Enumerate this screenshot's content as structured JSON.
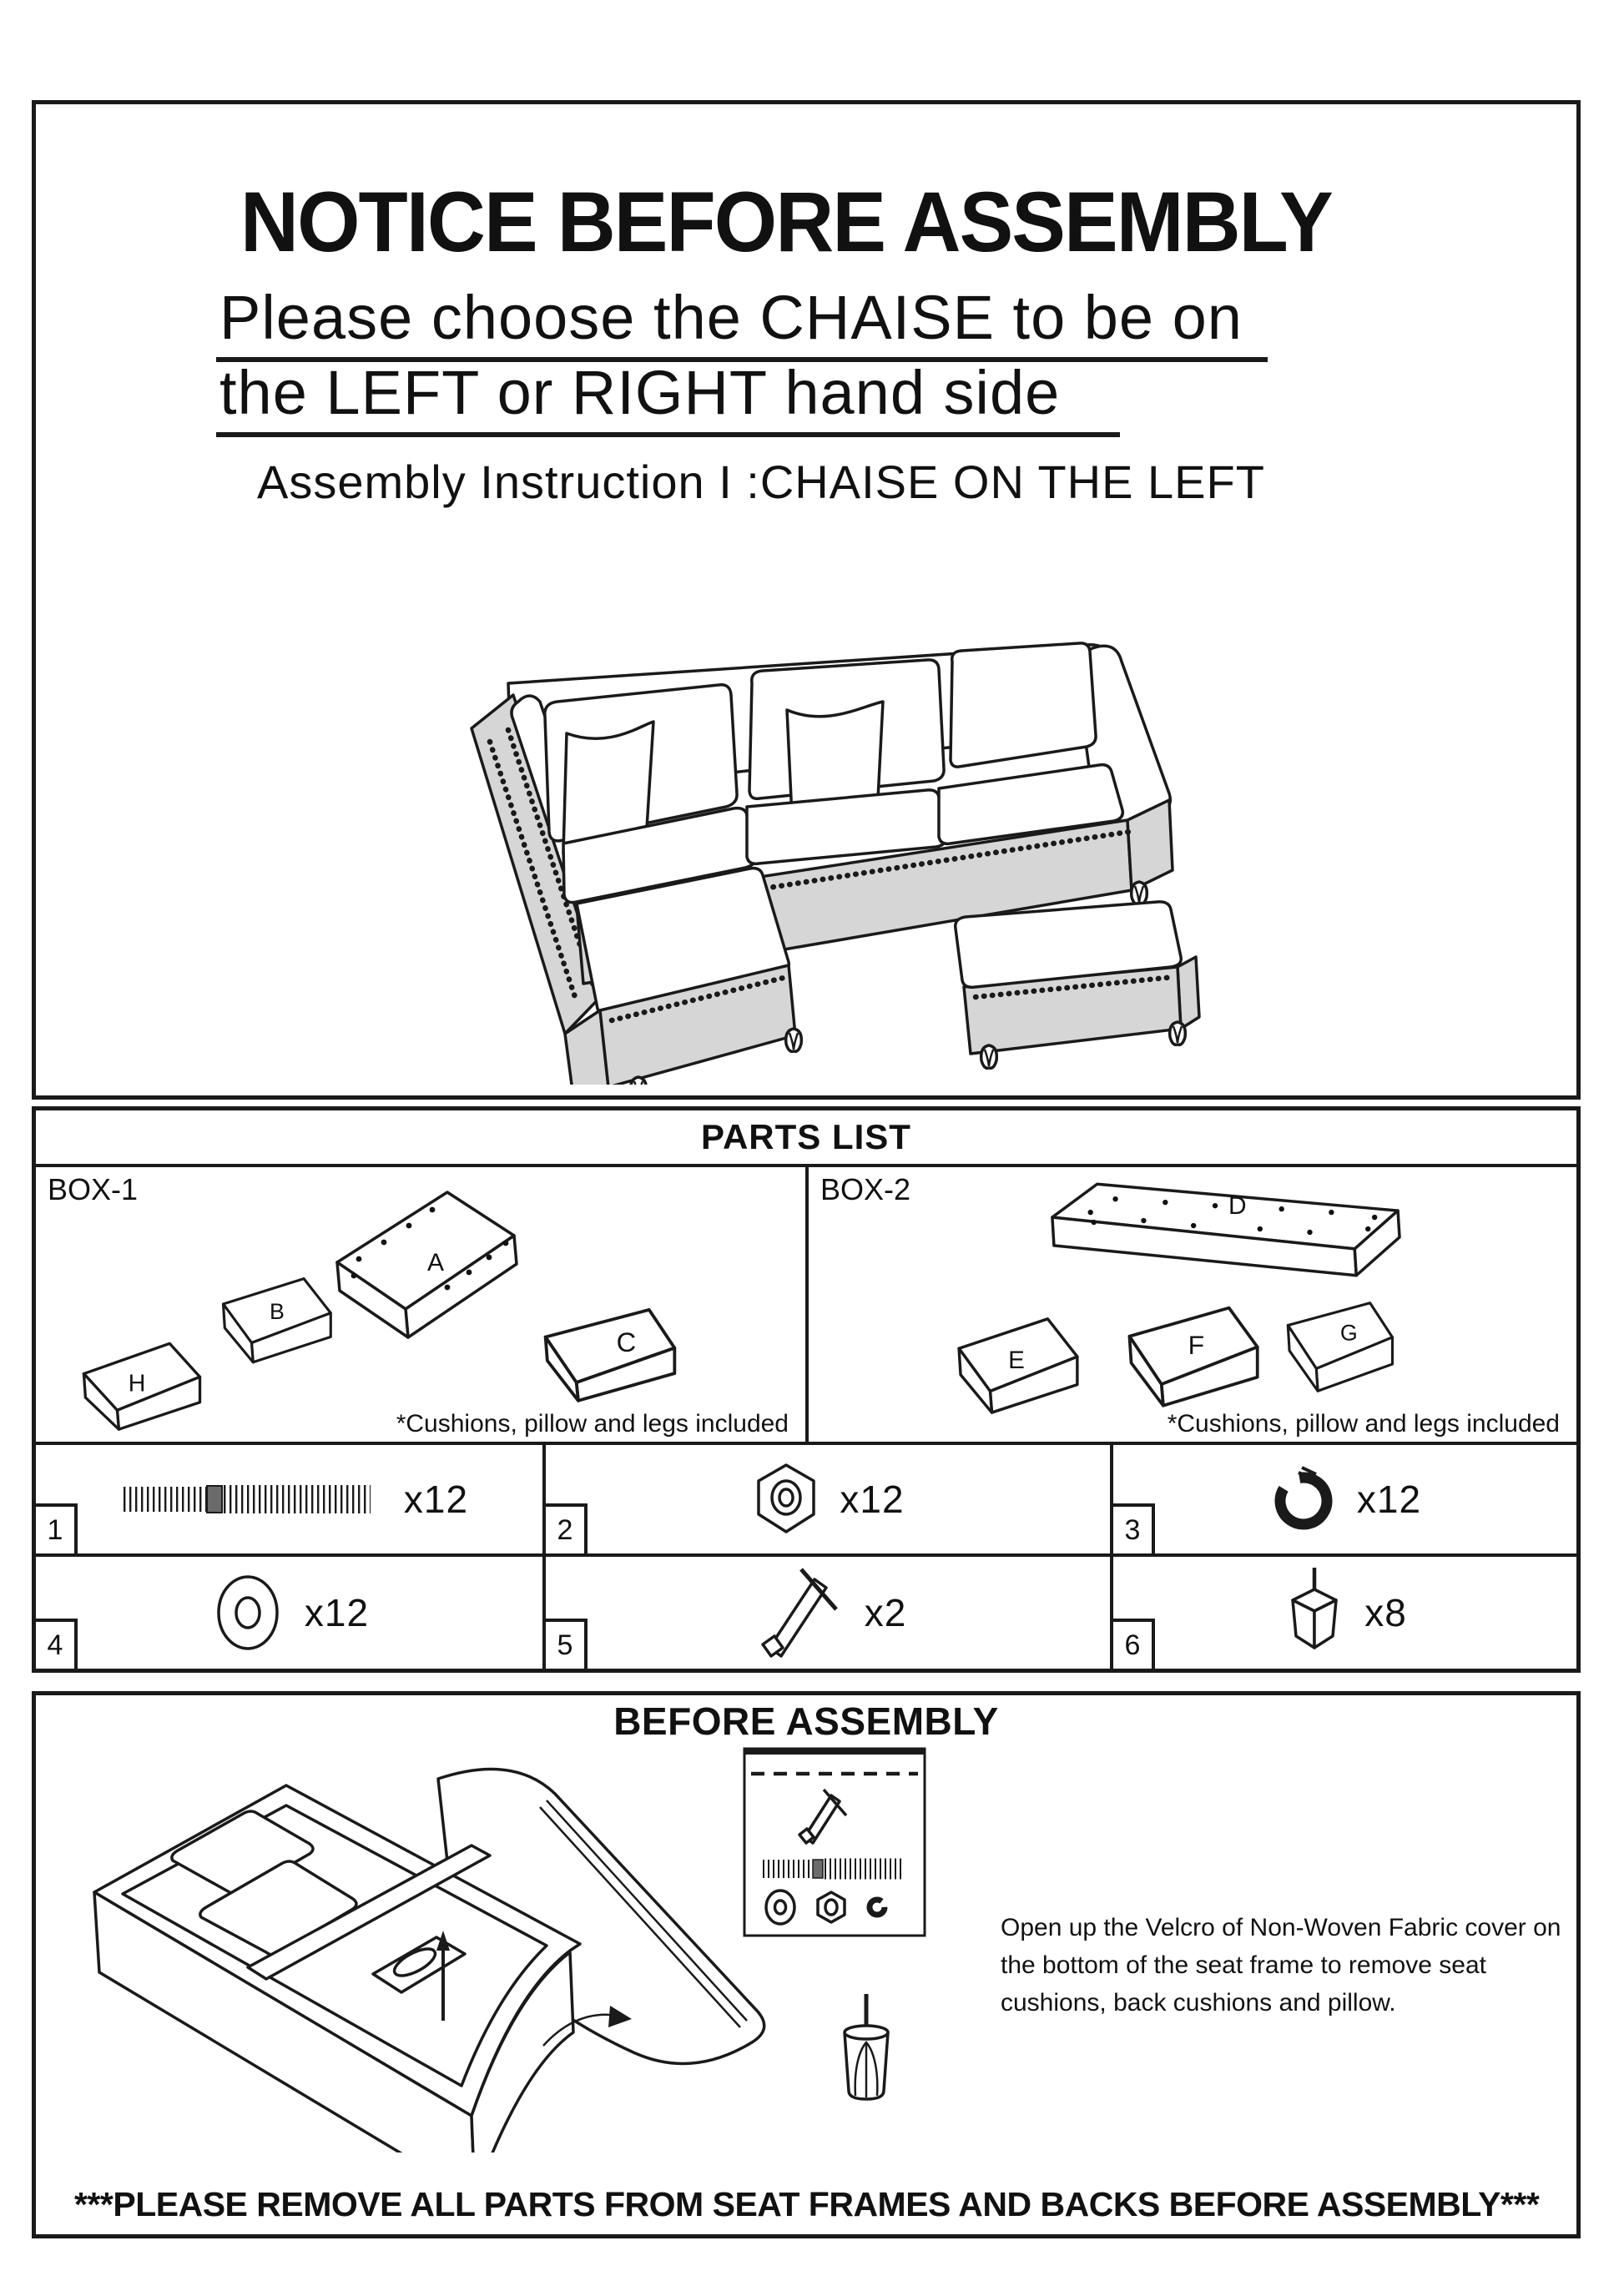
{
  "colors": {
    "line": "#1a1a1a",
    "panel_gray": "#d6d6d6",
    "paper": "#ffffff"
  },
  "header": {
    "title": "NOTICE BEFORE ASSEMBLY",
    "subtitle_line1": "Please choose the CHAISE to be on",
    "subtitle_line2": "the LEFT or RIGHT hand side",
    "instruction_line": "Assembly Instruction I :CHAISE ON THE LEFT"
  },
  "parts_list": {
    "header": "PARTS LIST",
    "box1": {
      "label": "BOX-1",
      "parts": [
        "A",
        "B",
        "H",
        "C"
      ],
      "footnote": "*Cushions, pillow and legs included"
    },
    "box2": {
      "label": "BOX-2",
      "parts": [
        "D",
        "E",
        "F",
        "G"
      ],
      "footnote": "*Cushions, pillow and legs included"
    },
    "hardware": [
      {
        "num": "1",
        "qty": "x12",
        "item": "bolt-icon"
      },
      {
        "num": "2",
        "qty": "x12",
        "item": "nut-icon"
      },
      {
        "num": "3",
        "qty": "x12",
        "item": "spring-washer-icon"
      },
      {
        "num": "4",
        "qty": "x12",
        "item": "flat-washer-icon"
      },
      {
        "num": "5",
        "qty": "x2",
        "item": "wrench-tool-icon"
      },
      {
        "num": "6",
        "qty": "x8",
        "item": "leg-icon"
      }
    ]
  },
  "before_assembly": {
    "header": "BEFORE ASSEMBLY",
    "note": "Open up the Velcro of Non-Woven Fabric cover on the bottom of the seat frame to remove seat cushions, back cushions and pillow.",
    "footer": "***PLEASE REMOVE ALL PARTS FROM SEAT FRAMES AND BACKS BEFORE ASSEMBLY***"
  }
}
